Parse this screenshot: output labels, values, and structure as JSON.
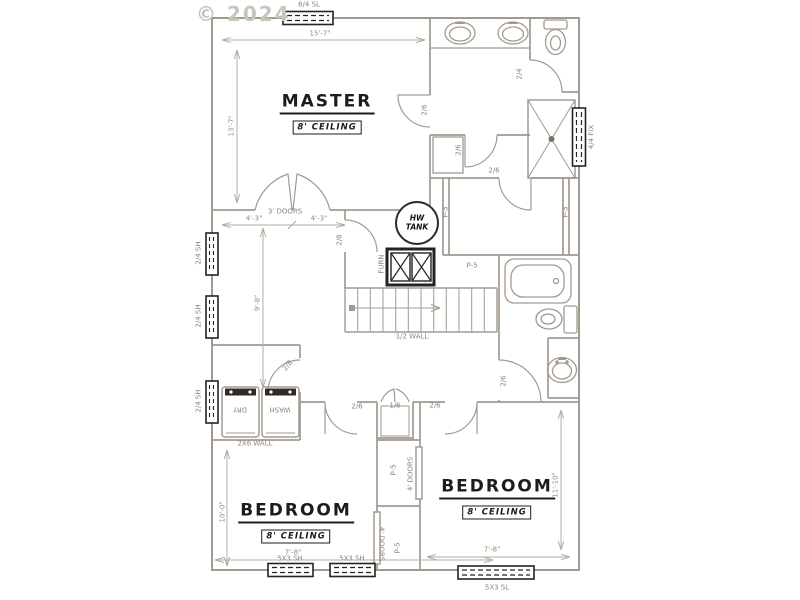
{
  "copyright": "© 2024",
  "rooms": {
    "master": {
      "name": "MASTER",
      "ceiling": "8' CEILING"
    },
    "bedroom_left": {
      "name": "BEDROOM",
      "ceiling": "8' CEILING"
    },
    "bedroom_right": {
      "name": "BEDROOM",
      "ceiling": "8' CEILING"
    }
  },
  "equipment": {
    "hw_line1": "HW",
    "hw_line2": "TANK",
    "furnace": "FURN",
    "washer": "WASH",
    "dryer": "DRY"
  },
  "wall_labels": {
    "half_wall": "1/2 WALL",
    "wall_2x6": "2X6 WALL",
    "plumbing": [
      "P-5",
      "P-5",
      "P-5",
      "P-5",
      "P-5"
    ]
  },
  "windows": {
    "top": "6/4 SL",
    "right_fix": "4/4 FIX",
    "left": [
      "2/4 SH",
      "2/4 SH",
      "2/4 SH"
    ],
    "bottom_left": [
      "5X3 SH",
      "5X3 SH"
    ],
    "bottom_right": "5X3 SL"
  },
  "doors": {
    "master_closet": "3' DOORS",
    "master_bath": "2/6",
    "bath_cabinet": "2/6",
    "hall_room": "2/6",
    "wc": "2/4",
    "mech": "2/8",
    "laundry": "2/8",
    "bedroom_left": "2/6",
    "linen": "1/6",
    "bedroom_right": "2/6",
    "hall_bath": "2/6",
    "closet_right": "4' DOORS",
    "closet_left": "4' DOORS"
  },
  "dimensions": {
    "master_width": "15'-7\"",
    "master_depth": "13'-7\"",
    "closet_a": "4'-3\"",
    "closet_b": "4'-3\"",
    "hall_depth": "9'-8\"",
    "bed_left_depth": "10'-0\"",
    "bed_left_width": "7'-8\"",
    "bed_right_width": "7'-8\"",
    "bed_right_depth": "11'-10\""
  },
  "colors": {
    "wall": "#a29a8f",
    "dark": "#232323",
    "dim": "#b3aca1"
  }
}
